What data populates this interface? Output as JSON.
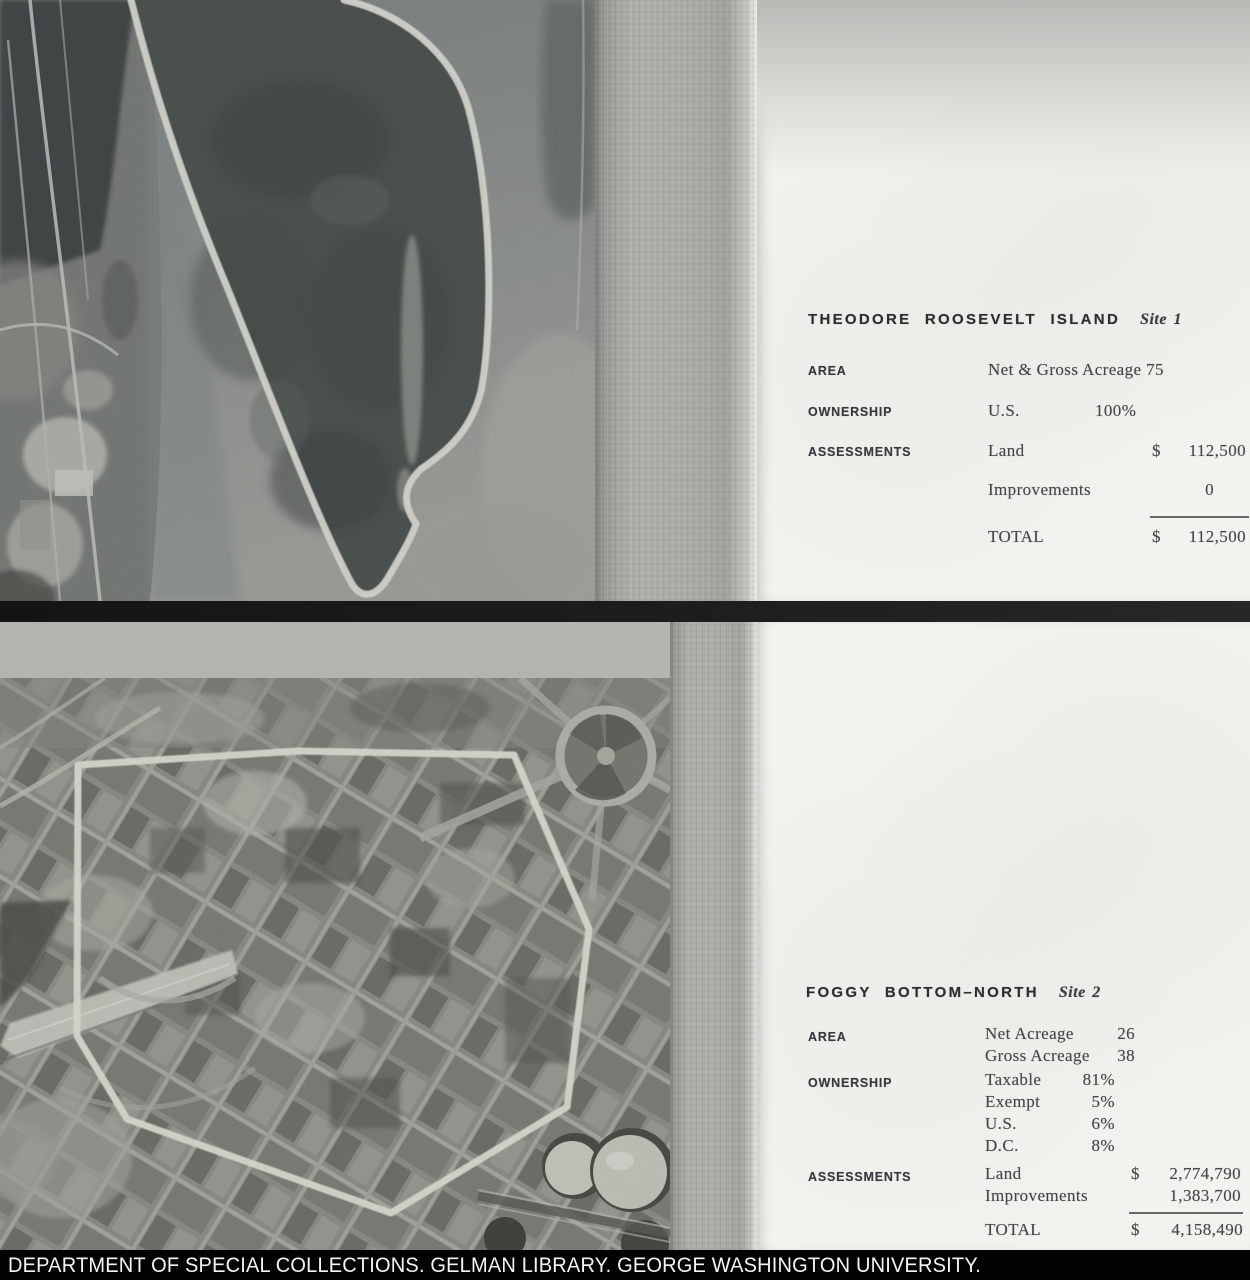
{
  "caption": {
    "text": "DEPARTMENT OF SPECIAL COLLECTIONS. GELMAN LIBRARY. GEORGE WASHINGTON UNIVERSITY."
  },
  "site1": {
    "heading": "THEODORE ROOSEVELT ISLAND",
    "site_label": "Site 1",
    "area_label": "AREA",
    "area_value": "Net & Gross Acreage 75",
    "ownership_label": "OWNERSHIP",
    "ownership": [
      {
        "name": "U.S.",
        "pct": "100%"
      }
    ],
    "assessments_label": "ASSESSMENTS",
    "assessments": [
      {
        "name": "Land",
        "dollar": "$",
        "amount": "112,500"
      },
      {
        "name": "Improvements",
        "dollar": "",
        "amount": "0"
      }
    ],
    "total": {
      "label": "TOTAL",
      "dollar": "$",
      "amount": "112,500"
    }
  },
  "site2": {
    "heading": "FOGGY BOTTOM–NORTH",
    "site_label": "Site 2",
    "area_label": "AREA",
    "area": [
      {
        "name": "Net Acreage",
        "value": "26"
      },
      {
        "name": "Gross Acreage",
        "value": "38"
      }
    ],
    "ownership_label": "OWNERSHIP",
    "ownership": [
      {
        "name": "Taxable",
        "pct": "81%"
      },
      {
        "name": "Exempt",
        "pct": "5%"
      },
      {
        "name": "U.S.",
        "pct": "6%"
      },
      {
        "name": "D.C.",
        "pct": "8%"
      }
    ],
    "assessments_label": "ASSESSMENTS",
    "assessments": [
      {
        "name": "Land",
        "dollar": "$",
        "amount": "2,774,790"
      },
      {
        "name": "Improvements",
        "dollar": "",
        "amount": "1,383,700"
      }
    ],
    "total": {
      "label": "TOTAL",
      "dollar": "$",
      "amount": "4,158,490"
    }
  },
  "colors": {
    "page": "#f3f2ee",
    "gutter": "#abaaa6",
    "divider": "#1c1c1c",
    "caption_bg": "#030303",
    "caption_text": "#f4f4f4",
    "boundary_white": "#f4f4ea"
  }
}
